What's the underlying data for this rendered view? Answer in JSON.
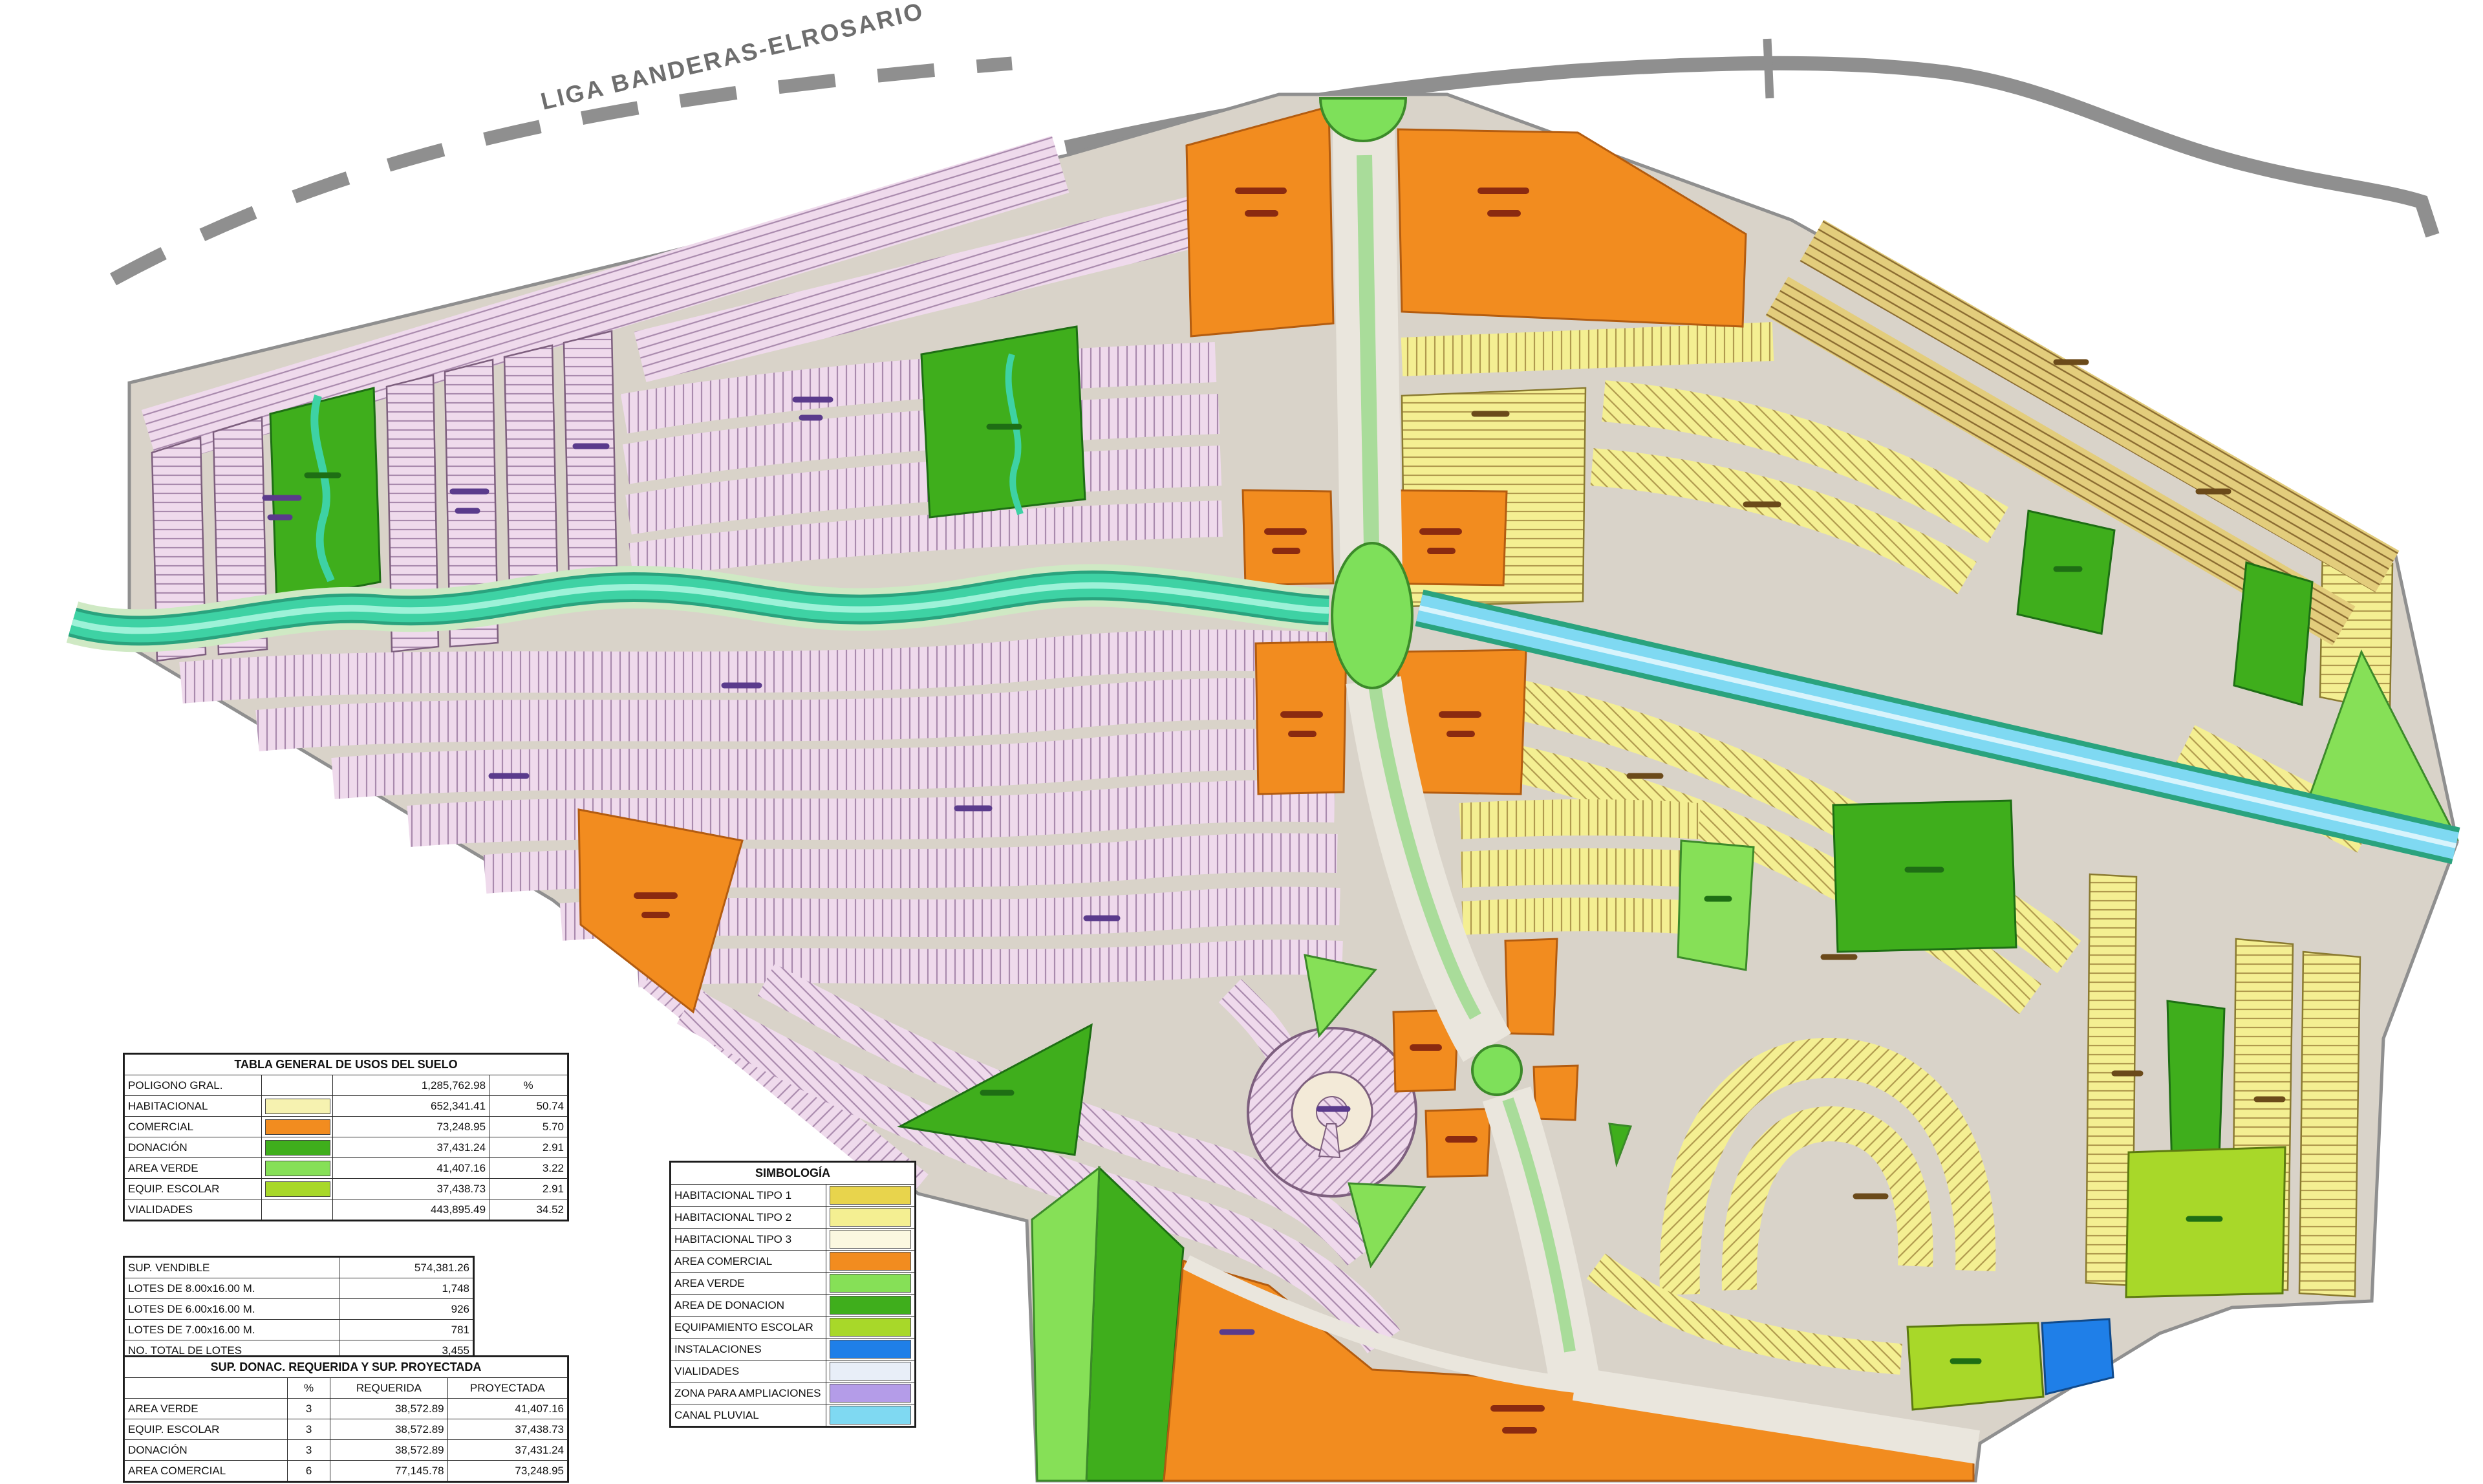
{
  "map": {
    "highway_label": "LIGA BANDERAS-ELROSARIO",
    "palette": {
      "pink": "#efdaec",
      "pinkLine": "#a98aad",
      "pinkEdge": "#7d5f7e",
      "yellow": "#f4ef92",
      "yellowLine": "#b09a4e",
      "yellowEdge": "#8a7a30",
      "tan": "#e3cd7c",
      "tanLine": "#8a6b30",
      "orange": "#f28c1f",
      "orangeEdge": "#b35c10",
      "greenDark": "#3fae1c",
      "greenDarkEdge": "#1e6e14",
      "greenLight": "#86e057",
      "lime": "#a8d829",
      "blue": "#1f7fe8",
      "canal": "#3ed2a4",
      "canalEdge": "#2aa37e",
      "canalCore": "#9df2d8",
      "drain": "#7fd9f2",
      "drainCore": "#d8f4fc",
      "base": "#d9d3c9",
      "roadLight": "#eae6dd",
      "roadEdge": "#8f8f8f",
      "median": "#a9dc9a",
      "cream": "#f3ead8",
      "rbGreen": "#7ee05a",
      "rbEdge": "#3c8a2a"
    }
  },
  "legend": {
    "title": "SIMBOLOGÍA",
    "rows": [
      {
        "label": "HABITACIONAL  TIPO 1",
        "color": "#e8d44c"
      },
      {
        "label": "HABITACIONAL  TIPO 2",
        "color": "#f4ef92"
      },
      {
        "label": "HABITACIONAL  TIPO 3",
        "color": "#fbf8e0"
      },
      {
        "label": "AREA COMERCIAL",
        "color": "#f28c1f"
      },
      {
        "label": "AREA VERDE",
        "color": "#86e057"
      },
      {
        "label": "AREA DE DONACION",
        "color": "#3fae1c"
      },
      {
        "label": "EQUIPAMIENTO ESCOLAR",
        "color": "#a8d829"
      },
      {
        "label": "INSTALACIONES",
        "color": "#1f7fe8"
      },
      {
        "label": "VIALIDADES",
        "color": "#e8eef8"
      },
      {
        "label": "ZONA PARA AMPLIACIONES",
        "color": "#b49ce8"
      },
      {
        "label": "CANAL PLUVIAL",
        "color": "#7fd9f2"
      }
    ]
  },
  "tables": {
    "general": {
      "title": "TABLA GENERAL DE USOS DEL SUELO",
      "header": {
        "label": "POLIGONO GRAL.",
        "value": "1,285,762.98",
        "pct": "%"
      },
      "rows": [
        {
          "label": "HABITACIONAL",
          "swatch": "#f6f2b0",
          "value": "652,341.41",
          "pct": "50.74"
        },
        {
          "label": "COMERCIAL",
          "swatch": "#f28c1f",
          "value": "73,248.95",
          "pct": "5.70"
        },
        {
          "label": "DONACIÓN",
          "swatch": "#3fae1c",
          "value": "37,431.24",
          "pct": "2.91"
        },
        {
          "label": "AREA VERDE",
          "swatch": "#86e057",
          "value": "41,407.16",
          "pct": "3.22"
        },
        {
          "label": "EQUIP. ESCOLAR",
          "swatch": "#a8d829",
          "value": "37,438.73",
          "pct": "2.91"
        },
        {
          "label": "VIALIDADES",
          "swatch": "",
          "value": "443,895.49",
          "pct": "34.52"
        }
      ]
    },
    "vendible": {
      "title": "SUP. VENDIBLE",
      "total": "574,381.26",
      "rows": [
        {
          "label": "LOTES DE 8.00x16.00 M.",
          "value": "1,748"
        },
        {
          "label": "LOTES DE 6.00x16.00 M.",
          "value": "926"
        },
        {
          "label": "LOTES DE 7.00x16.00 M.",
          "value": "781"
        },
        {
          "label": "NO. TOTAL DE LOTES",
          "value": "3,455"
        }
      ]
    },
    "donacion": {
      "title": "SUP. DONAC. REQUERIDA Y SUP. PROYECTADA",
      "headers": [
        "",
        "%",
        "REQUERIDA",
        "PROYECTADA"
      ],
      "rows": [
        {
          "label": "AREA VERDE",
          "pct": "3",
          "req": "38,572.89",
          "proy": "41,407.16"
        },
        {
          "label": "EQUIP. ESCOLAR",
          "pct": "3",
          "req": "38,572.89",
          "proy": "37,438.73"
        },
        {
          "label": "DONACIÓN",
          "pct": "3",
          "req": "38,572.89",
          "proy": "37,431.24"
        },
        {
          "label": "AREA COMERCIAL",
          "pct": "6",
          "req": "77,145.78",
          "proy": "73,248.95"
        }
      ]
    }
  }
}
